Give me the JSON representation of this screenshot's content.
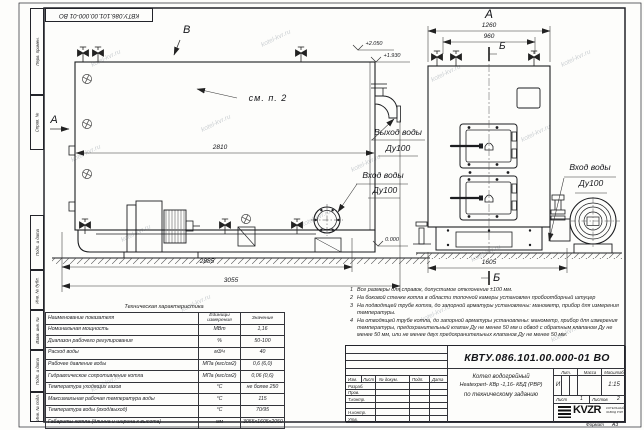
{
  "watermark": "kotel-kvr.ru",
  "corner_stamp": "КВТУ.086.101.00.000-01 ВО",
  "frame": {
    "stamp_labels": [
      "Перв. примен.",
      "Справ. №",
      "Подп. и дата",
      "Инв. № дубл.",
      "Взам. инв. №",
      "Подп. и дата",
      "Инв. № подл."
    ],
    "format_label": "Формат",
    "format_value": "А3"
  },
  "side_view": {
    "arrow_a": "А",
    "arrow_v": "В",
    "see_note": "см. п. 2",
    "outlet_line1": "Выход воды",
    "outlet_line2": "Ду100",
    "inlet_line1": "Вход воды",
    "inlet_line2": "Ду100",
    "elev_top": "+2.050",
    "elev_mid": "+1.930",
    "elev_zero": "0.000",
    "dim_2810": "2810",
    "dim_2885": "2885",
    "dim_3055": "3055"
  },
  "front_view": {
    "view_label": "А",
    "dim_1260": "1260",
    "dim_960": "960",
    "dim_1605": "1605",
    "section_top": "Б",
    "section_bottom": "Б",
    "inlet_line1": "Вход воды",
    "inlet_line2": "Ду100"
  },
  "notes": [
    {
      "num": "1",
      "text": "Все размеры для справок, допустимое отклонение ±100 мм."
    },
    {
      "num": "2",
      "text": "На боковой стенке котла в области топочной камеры установлен пробоотборный штуцер"
    },
    {
      "num": "3",
      "text": "На  подводящей трубе котла, до запорной арматуры установлены: манометр, прибор для измерения температуры."
    },
    {
      "num": "4",
      "text": "На отводящей трубе котла, до запорной арматуры установлены: манометр, прибор для измерения температуры, предохранительный клапан Ду не менее 50 мм и обвод с обратным клапаном Ду не менее 50 мм, или не менее двух предохранительных клапанов Ду не менее 50 мм."
    }
  ],
  "spec_table": {
    "title": "Техническая характеристика",
    "col_name": "Наименование показателя",
    "col_units": "Единицы измерения",
    "col_value": "Значение",
    "rows": [
      {
        "name": "Номинальная мощность",
        "units": "МВт",
        "value": "1,16"
      },
      {
        "name": "Диапазон рабочего регулирования",
        "units": "%",
        "value": "50-100"
      },
      {
        "name": "Расход воды",
        "units": "м3/ч",
        "value": "40"
      },
      {
        "name": "Рабочее давление воды",
        "units": "МПа (кгс/см2)",
        "value": "0,6 (6,0)"
      },
      {
        "name": "Гидравлическое сопротивление котла",
        "units": "МПа (кгс/см2)",
        "value": "0,06 (0,6)"
      },
      {
        "name": "Температура уходящих газов",
        "units": "°С",
        "value": "не более 250"
      },
      {
        "name": "Максимальная рабочая температура воды",
        "units": "°С",
        "value": "115"
      },
      {
        "name": "Температура воды (вход/выход)",
        "units": "°С",
        "value": "70/95"
      },
      {
        "name": "Габариты котла (длинна и ширина к высота)",
        "units": "мм",
        "value": "3055х1605х2050"
      }
    ]
  },
  "title_block": {
    "doc_number": "КВТУ.086.101.00.000-01 ВО",
    "name_line1": "Котел водогрейный",
    "name_line2": "Heatexpert- КВр -1,16- КБД (РВР)",
    "name_line3": "по техническому заданию",
    "cols": {
      "izm": "Изм.",
      "list": "Лист",
      "doc": "№ докум.",
      "podp": "Подп.",
      "data": "Дата"
    },
    "rows": [
      "Разраб.",
      "Пров.",
      "Т.контр.",
      "",
      "Н.контр.",
      "Утв."
    ],
    "lit_label": "Лит.",
    "mass_label": "Масса",
    "scale_label": "Масштаб",
    "lit_value": "И",
    "scale_value": "1:15",
    "sheet_label": "Лист",
    "sheet_value": "1",
    "sheets_label": "Листов",
    "sheets_value": "2",
    "logo_text": "KVZR",
    "logo_sub1": "КОТЕЛЬНЫЙ",
    "logo_sub2": "ЗАВОД РЭП"
  }
}
